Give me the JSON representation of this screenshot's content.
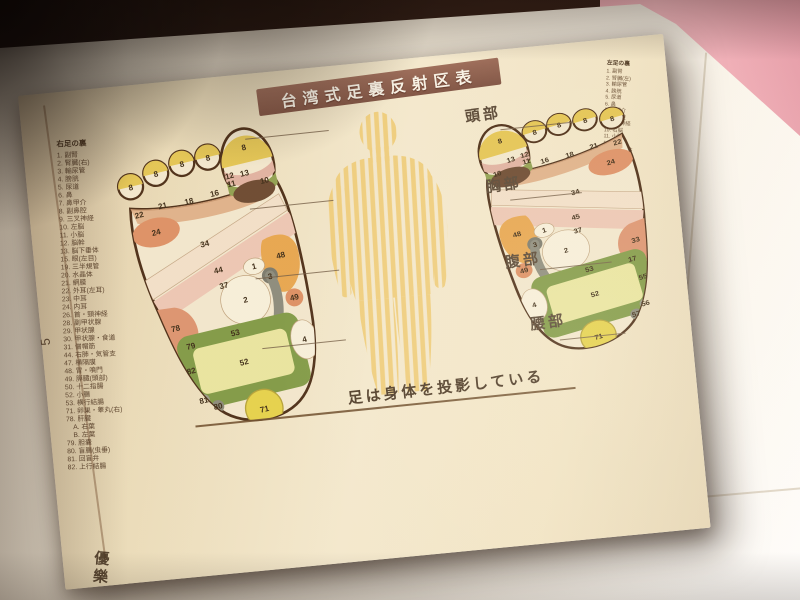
{
  "page": {
    "title": "台湾式足裏反射区表",
    "page_number": "5",
    "stamp": "優樂",
    "caption": "足は身体を投影している",
    "body_section_labels": [
      "頭部",
      "胸部",
      "腹部",
      "腰部"
    ],
    "left_list": {
      "header": "右足の裏",
      "items": [
        "1. 副腎",
        "2. 腎臓(右)",
        "3. 輸尿管",
        "4. 膀胱",
        "5. 尿道",
        "6. 鼻",
        "7. 鼻甲介",
        "8. 副鼻腔",
        "9. 三叉神経",
        "10. 左脳",
        "11. 小脳",
        "12. 脳幹",
        "13. 脳下垂体",
        "15. 眼(左目)",
        "19. 三半規管",
        "20. 水晶体",
        "21. 網膜",
        "22. 外耳(左耳)",
        "23. 中耳",
        "24. 内耳",
        "26. 首・頸神経",
        "28. 副甲状腺",
        "29. 甲状腺",
        "30. 甲状腺・食道",
        "31. 僧帽筋",
        "44. 右肺・気管支",
        "47. 横隔膜",
        "48. 胃・噴門",
        "49. 膵臓(頭部)",
        "50. 十二指腸",
        "52. 小腸",
        "53. 横行結腸",
        "71. 卵巣・睾丸(右)",
        "78. 肝臓",
        "　A. 右葉",
        "　B. 左葉",
        "79. 胆嚢",
        "80. 盲腸(虫垂)",
        "81. 回盲弁",
        "82. 上行結腸"
      ]
    },
    "right_list": {
      "header": "左足の裏",
      "items": [
        "1. 副腎",
        "2. 腎臓(左)",
        "3. 輸尿管",
        "4. 膀胱",
        "5. 尿道",
        "6. 鼻",
        "7. 鼻甲介",
        "8. 副鼻腔",
        "9. 三叉神経",
        "10. 右脳",
        "11. 小脳",
        "12. 脳幹",
        "13. 脳下垂体",
        "15. 眼(右目)",
        "19. 三半規管",
        "20. 水晶体",
        "21. 網膜",
        "22. 外耳(右耳)",
        "23. 中耳",
        "24. 内耳",
        "26. 首・頸神経",
        "28. 副甲状腺",
        "29. 甲状腺",
        "30. 甲状腺・食道",
        "31. 僧帽筋",
        "33. 心臓",
        "34. 脾臓",
        "45. 左肺・気管支",
        "47. 横隔膜",
        "48. 胃・幽門",
        "49. 膵臓(体尾部)",
        "50. 十二指腸",
        "52. 小腸",
        "53. 横行結腸",
        "55. 下行結腸",
        "56. S状結腸・直腸",
        "57. 肛門",
        "71. 卵巣・睾丸(左)"
      ]
    },
    "left_foot_labels": [
      {
        "t": "8",
        "x": 22,
        "y": 60
      },
      {
        "t": "8",
        "x": 53,
        "y": 52
      },
      {
        "t": "8",
        "x": 84,
        "y": 48
      },
      {
        "t": "8",
        "x": 114,
        "y": 48
      },
      {
        "t": "8",
        "x": 156,
        "y": 46
      },
      {
        "t": "22",
        "x": 24,
        "y": 92,
        "s": 7
      },
      {
        "t": "21",
        "x": 52,
        "y": 88,
        "s": 7
      },
      {
        "t": "18",
        "x": 82,
        "y": 90,
        "s": 7
      },
      {
        "t": "16",
        "x": 112,
        "y": 88,
        "s": 7
      },
      {
        "t": "13",
        "x": 150,
        "y": 74,
        "s": 7
      },
      {
        "t": "12",
        "x": 133,
        "y": 73,
        "s": 6
      },
      {
        "t": "11",
        "x": 133,
        "y": 82,
        "s": 6
      },
      {
        "t": "10",
        "x": 170,
        "y": 87,
        "s": 7,
        "f": "#f4efdc"
      },
      {
        "t": "24",
        "x": 38,
        "y": 115
      },
      {
        "t": "34",
        "x": 88,
        "y": 140
      },
      {
        "t": "44",
        "x": 96,
        "y": 172
      },
      {
        "t": "78",
        "x": 34,
        "y": 224
      },
      {
        "t": "79",
        "x": 46,
        "y": 247,
        "s": 7
      },
      {
        "t": "1",
        "x": 136,
        "y": 177,
        "s": 7
      },
      {
        "t": "37",
        "x": 98,
        "y": 190,
        "s": 7
      },
      {
        "t": "2",
        "x": 118,
        "y": 211
      },
      {
        "t": "3",
        "x": 151,
        "y": 192,
        "f": "#f4efdc"
      },
      {
        "t": "48",
        "x": 168,
        "y": 172
      },
      {
        "t": "49",
        "x": 172,
        "y": 221,
        "s": 7
      },
      {
        "t": "53",
        "x": 98,
        "y": 244
      },
      {
        "t": "82",
        "x": 40,
        "y": 274
      },
      {
        "t": "81",
        "x": 46,
        "y": 309,
        "s": 6.5
      },
      {
        "t": "80",
        "x": 60,
        "y": 319,
        "s": 6.5
      },
      {
        "t": "52",
        "x": 100,
        "y": 278
      },
      {
        "t": "4",
        "x": 172,
        "y": 269
      },
      {
        "t": "71",
        "x": 110,
        "y": 334
      }
    ],
    "right_foot_labels": [
      {
        "t": "8",
        "x": 178,
        "y": 60
      },
      {
        "t": "8",
        "x": 147,
        "y": 52
      },
      {
        "t": "8",
        "x": 116,
        "y": 48
      },
      {
        "t": "8",
        "x": 86,
        "y": 48
      },
      {
        "t": "8",
        "x": 44,
        "y": 46
      },
      {
        "t": "22",
        "x": 176,
        "y": 92,
        "s": 7
      },
      {
        "t": "21",
        "x": 148,
        "y": 88,
        "s": 7
      },
      {
        "t": "18",
        "x": 118,
        "y": 90,
        "s": 7
      },
      {
        "t": "16",
        "x": 88,
        "y": 88,
        "s": 7
      },
      {
        "t": "13",
        "x": 50,
        "y": 74,
        "s": 7
      },
      {
        "t": "12",
        "x": 67,
        "y": 73,
        "s": 6
      },
      {
        "t": "11",
        "x": 67,
        "y": 82,
        "s": 6
      },
      {
        "t": "10",
        "x": 30,
        "y": 87,
        "s": 7,
        "f": "#f4efdc"
      },
      {
        "t": "24",
        "x": 162,
        "y": 115
      },
      {
        "t": "34",
        "x": 112,
        "y": 140
      },
      {
        "t": "45",
        "x": 104,
        "y": 172
      },
      {
        "t": "33",
        "x": 164,
        "y": 224
      },
      {
        "t": "17",
        "x": 154,
        "y": 247,
        "s": 7
      },
      {
        "t": "1",
        "x": 64,
        "y": 177,
        "s": 7
      },
      {
        "t": "37",
        "x": 102,
        "y": 190,
        "s": 7
      },
      {
        "t": "2",
        "x": 82,
        "y": 211
      },
      {
        "t": "3",
        "x": 49,
        "y": 192,
        "f": "#f4efdc"
      },
      {
        "t": "48",
        "x": 32,
        "y": 172
      },
      {
        "t": "49",
        "x": 28,
        "y": 221,
        "s": 7
      },
      {
        "t": "53",
        "x": 102,
        "y": 244
      },
      {
        "t": "55",
        "x": 160,
        "y": 274
      },
      {
        "t": "56",
        "x": 154,
        "y": 309,
        "s": 6.5
      },
      {
        "t": "57",
        "x": 140,
        "y": 319,
        "s": 6.5
      },
      {
        "t": "52",
        "x": 100,
        "y": 278
      },
      {
        "t": "4",
        "x": 28,
        "y": 269
      },
      {
        "t": "71",
        "x": 90,
        "y": 334
      }
    ],
    "colors": {
      "banner_brown": "#8d5a49",
      "paper_cream": "#f1e5c8",
      "toe_tip_yellow": "#e4c654",
      "zone_salmon": "#dd9066",
      "zone_orange": "#e7a64f",
      "zone_green_frame": "#7f9a46",
      "zone_inner_yellow_green": "#e9e6a0",
      "zone_gray_band": "#8b8b7d",
      "zone_brown_brain": "#6a4830",
      "heel_circle_yellow": "#e5d24b",
      "body_stripe_yellow": "#efce7e",
      "background_pink": "#eda6b2",
      "table_white": "#f7f3ea"
    }
  }
}
